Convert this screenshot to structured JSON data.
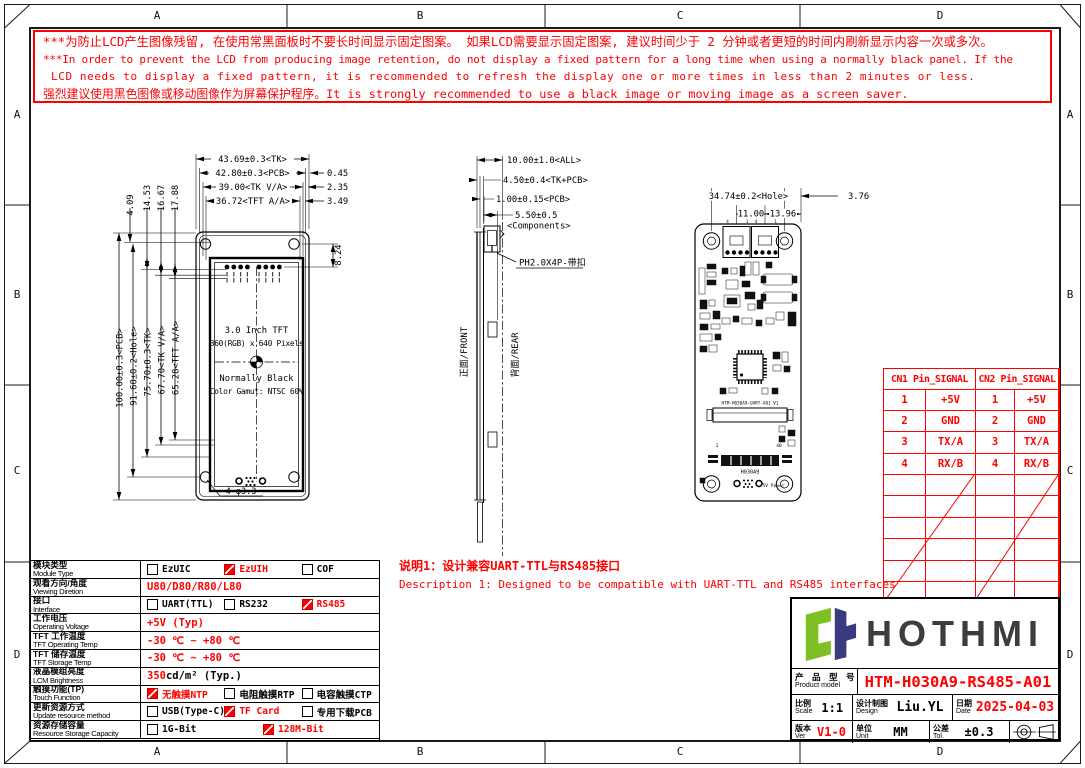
{
  "border": {
    "cols": [
      "A",
      "B",
      "C",
      "D"
    ],
    "rows": [
      "A",
      "B",
      "C",
      "D"
    ]
  },
  "warning": {
    "lines": [
      "***为防止LCD产生图像残留, 在使用常黑面板时不要长时间显示固定图案。 如果LCD需要显示固定图案, 建议时间少于 2 分钟或者更短的时间内刷新显示内容一次或多次。",
      "***In order to prevent the LCD from producing image retention, do not display a fixed pattern for a long time when using a normally black panel. If the",
      "LCD needs to display a fixed pattern, it is recommended to refresh the display one or more times in less than 2 minutes or less.",
      "强烈建议使用黑色图像或移动图像作为屏幕保护程序。It is strongly recommended to use a black image or moving image as a screen saver."
    ]
  },
  "front": {
    "dims_top": [
      "43.69±0.3<TK>",
      "42.80±0.3<PCB>",
      "39.00<TK V/A>",
      "36.72<TFT A/A>"
    ],
    "dims_side": [
      "0.45",
      "2.35",
      "3.49"
    ],
    "dims_small": [
      "4.09",
      "14.53",
      "16.67",
      "17.88"
    ],
    "dims_left": [
      "100.00±0.3<PCB>",
      "91.60±0.2<Hole>",
      "75.70±0.3<TK>",
      "67.70<TK V/A>",
      "65.28<TFT A/A>"
    ],
    "dim_right": "8.24",
    "screen": [
      "3.0 Inch TFT",
      "360(RGB) x 640 Pixels",
      "Normally Black",
      "Color Gamut: NTSC 60%"
    ],
    "hole_label": "4-φ3.3"
  },
  "side": {
    "dims": [
      "10.00±1.0<ALL>",
      "4.50±0.4<TK+PCB>",
      "1.00±0.15<PCB>",
      "5.50±0.5",
      "<Components>"
    ],
    "connector": "PH2.0X4P-带扣",
    "front_label": "正面/FRONT",
    "rear_label": "背面/REAR"
  },
  "rear": {
    "dims": [
      "34.74±0.2<Hole>",
      "3.76",
      "11.00",
      "13.96"
    ],
    "pin_nums": [
      "4",
      "1",
      "4",
      "1"
    ],
    "pcb_label": "HTM-H030A9-UART-A01 V1",
    "fpc_first": "1",
    "fpc_last": "40",
    "pcb_code": "H030A9",
    "power_label": "5V Power"
  },
  "pin_table": {
    "headers": [
      "CN1 Pin_SIGNAL",
      "CN2 Pin_SIGNAL"
    ],
    "rows": [
      [
        "1",
        "+5V",
        "1",
        "+5V"
      ],
      [
        "2",
        "GND",
        "2",
        "GND"
      ],
      [
        "3",
        "TX/A",
        "3",
        "TX/A"
      ],
      [
        "4",
        "RX/B",
        "4",
        "RX/B"
      ]
    ],
    "empty_rows": 6
  },
  "notes": {
    "cn": "说明1：设计兼容UART-TTL与RS485接口",
    "en": "Description 1: Designed to be compatible with UART-TTL and RS485 interfaces"
  },
  "spec_table": {
    "rows": [
      {
        "cn": "模块类型",
        "en": "Module Type",
        "type": "options",
        "options": [
          {
            "label": "EzUIC",
            "checked": false
          },
          {
            "label": "EzUIH",
            "checked": true
          },
          {
            "label": "COF",
            "checked": false
          }
        ]
      },
      {
        "cn": "观看方向/角度",
        "en": "Viewing Diretion",
        "type": "text",
        "text": "U80/D80/R80/L80"
      },
      {
        "cn": "接口",
        "en": "Interface",
        "type": "options",
        "options": [
          {
            "label": "UART(TTL)",
            "checked": false
          },
          {
            "label": "RS232",
            "checked": false
          },
          {
            "label": "RS485",
            "checked": true
          }
        ]
      },
      {
        "cn": "工作电压",
        "en": "Operating Voltage",
        "type": "text",
        "text": "+5V (Typ)"
      },
      {
        "cn": "TFT 工作温度",
        "en": "TFT Operating Temp",
        "type": "text",
        "text": "-30 ℃ ~ +80 ℃"
      },
      {
        "cn": "TFT 储存温度",
        "en": "TFT Storage Temp",
        "type": "text",
        "text": "-30 ℃ ~ +80 ℃"
      },
      {
        "cn": "液晶模组亮度",
        "en": "LCM Brightness",
        "type": "text2",
        "red_part": "350",
        "black_part": "  cd/m² (Typ.)"
      },
      {
        "cn": "触摸功能(TP)",
        "en": "Touch Function",
        "type": "options",
        "options": [
          {
            "label": "无触摸NTP",
            "checked": true
          },
          {
            "label": "电阻触摸RTP",
            "checked": false
          },
          {
            "label": "电容触摸CTP",
            "checked": false
          }
        ]
      },
      {
        "cn": "更新资源方式",
        "en": "Update resource method",
        "type": "options",
        "options": [
          {
            "label": "USB(Type-C)",
            "checked": false
          },
          {
            "label": "TF Card",
            "checked": true
          },
          {
            "label": "专用下载PCB",
            "checked": false
          }
        ]
      },
      {
        "cn": "资源存储容量",
        "en": "Resource Storage Capacity",
        "type": "options",
        "options": [
          {
            "label": "1G-Bit",
            "checked": false
          },
          {
            "label": "128M-Bit",
            "checked": true
          }
        ]
      }
    ]
  },
  "title_block": {
    "brand": "HOTHMI",
    "product_cn": "产 品 型 号",
    "product_en": "Product model",
    "model": "HTM-H030A9-RS485-A01",
    "scale_cn": "比例",
    "scale_en": "Scale",
    "scale": "1:1",
    "design_cn": "设计制图",
    "design_en": "Design",
    "designer": "Liu.YL",
    "date_cn": "日期",
    "date_en": "Date",
    "date": "2025-04-03",
    "ver_cn": "版本",
    "ver_en": "Ver",
    "ver": "V1-0",
    "unit_cn": "单位",
    "unit_en": "Unit",
    "unit": "MM",
    "tol_cn": "公差",
    "tol_en": "Tol.",
    "tol": "±0.3"
  },
  "colors": {
    "accent_red": "#fe0000",
    "logo_green": "#7fbf26",
    "logo_navy": "#3a3a80",
    "brand_gray": "#3d3d3d"
  }
}
